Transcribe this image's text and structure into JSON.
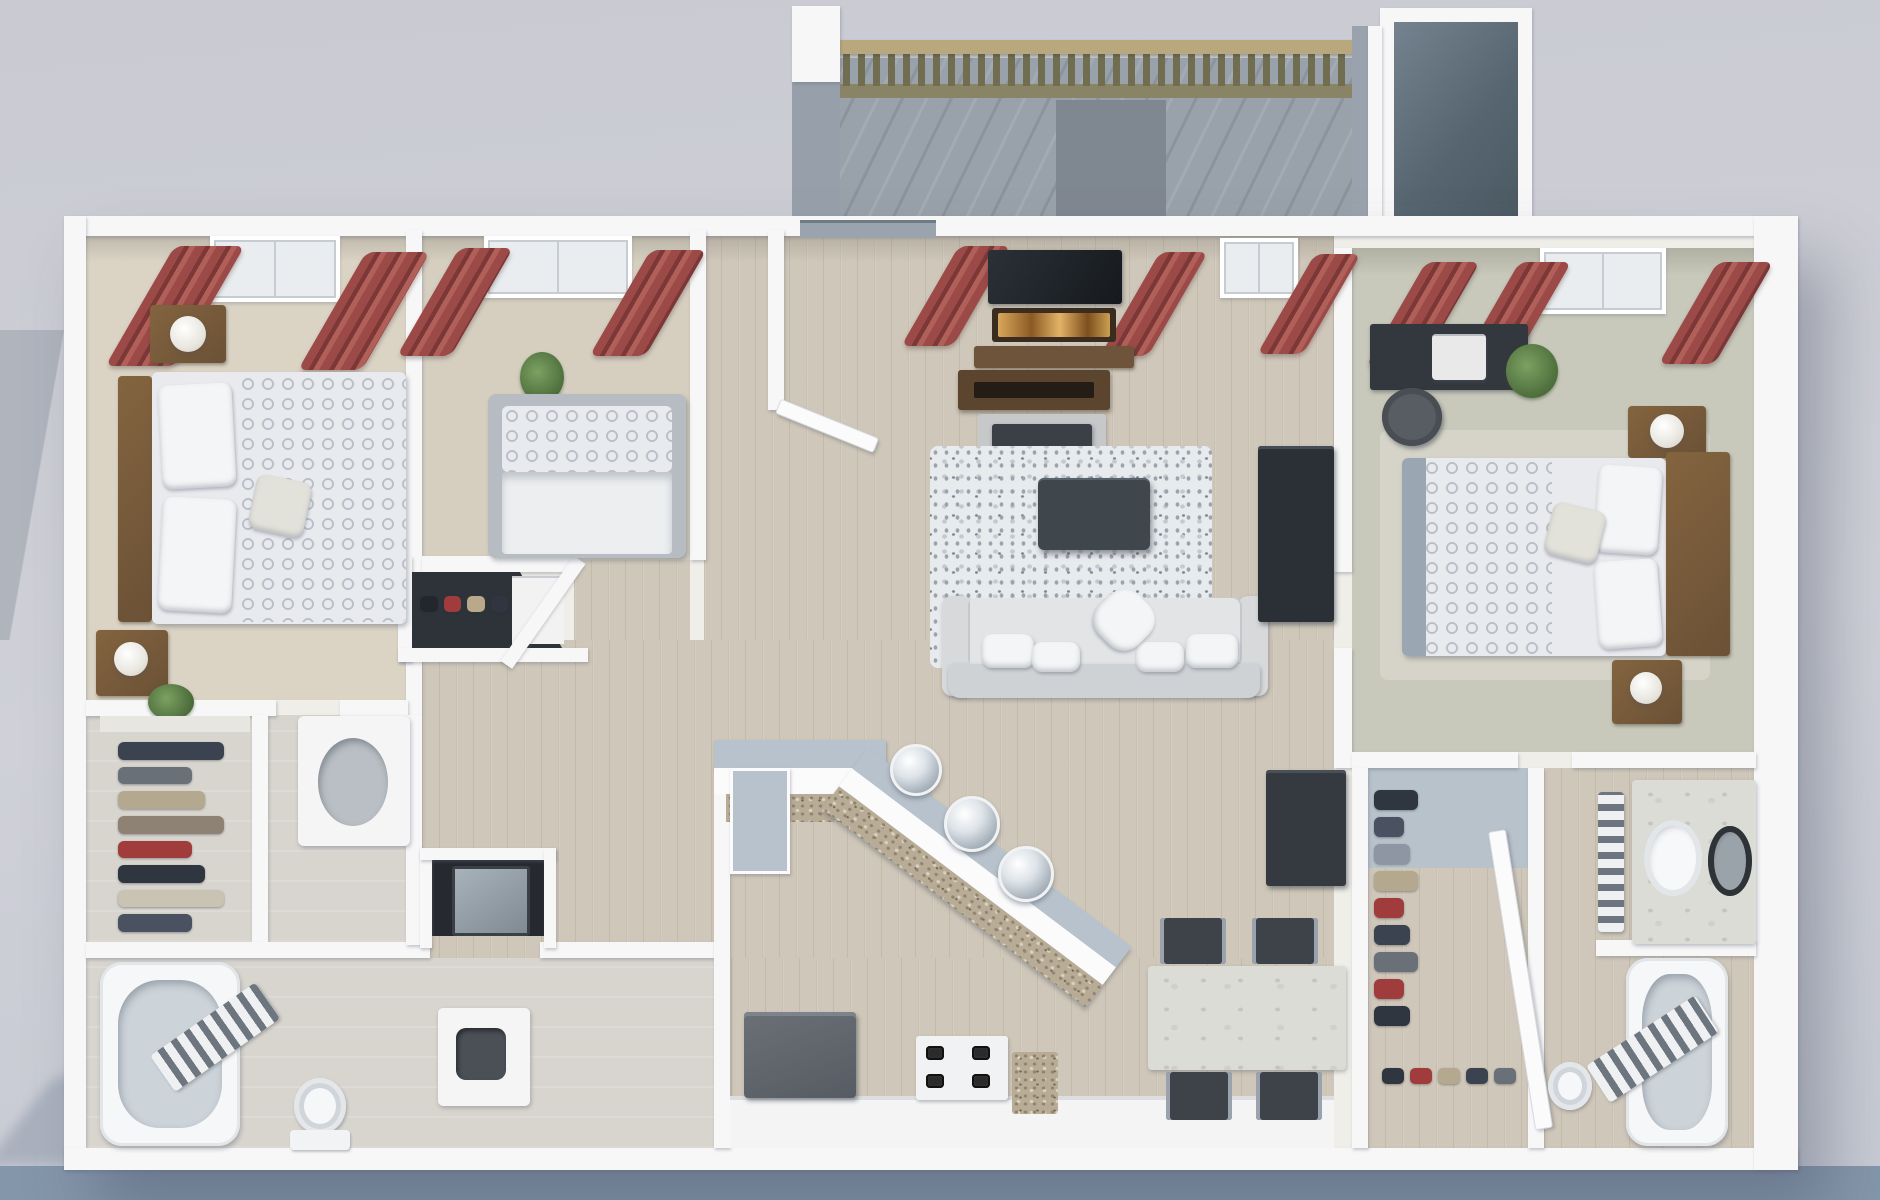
{
  "scene": {
    "type": "3d-floorplan-render",
    "view": "top-down-3d",
    "description": "3D rendered floor plan of a three-bedroom two-bath apartment with open living, kitchen, dining, walk-in closets and balcony"
  },
  "palette": {
    "wall": "#f7f7f8",
    "bgBand": "#8496aa",
    "wood": "#cfc7b9",
    "carpet1": "#dbd4c5",
    "carpet2": "#d6cfc0",
    "carpet3": "#c8c9bb",
    "tile": "#d8d5cf",
    "deck": "#99a1aa",
    "railWood": "#b9a87e",
    "baluster": "#716d50",
    "slate": "#5c6b78",
    "curtain": "#9c4a48",
    "curtainDark": "#7c3836",
    "headboard": "#6b5136",
    "nightstand": "#7a5c3c",
    "duvetBase": "#e9eaee",
    "duvetRing": "#b9c0c9",
    "sofa": "#d7d9db",
    "rugLight": "#e8ebee",
    "rugDark": "#9aa2ac",
    "coffeeTable": "#3f464c",
    "media": "#2b3036",
    "consoleWood": "#5b452f",
    "fire": "#e8a23c",
    "counterTop": "#b7c2cc",
    "granite": "#b9ac96",
    "appliance": "#565c63",
    "burner": "#2b2b2b",
    "marble": "#dcdcd6",
    "chair": "#3d4349",
    "tubInner": "#ccd3d9",
    "plant": "#4e6e3c",
    "closetDark": "#2e333a",
    "washer": "#7f8a93"
  },
  "closets": {
    "left_walkin": {
      "colors": [
        "#3c4350",
        "#6a7078",
        "#b4a98e",
        "#8d8273",
        "#a03c3c",
        "#2f3640",
        "#c9c3b4",
        "#4a5160"
      ]
    },
    "right_walkin": {
      "colors": [
        "#2f3640",
        "#4a5160",
        "#8d96a2",
        "#b4a98e",
        "#a03c3c",
        "#3c4350",
        "#6a7078",
        "#a03c3c",
        "#2f3640"
      ]
    },
    "right_shoes": {
      "colors": [
        "#2f3640",
        "#a03c3c",
        "#b4a98e",
        "#3c4350",
        "#6a7078"
      ]
    },
    "bedroom2_closet": {
      "colors": [
        "#23262b",
        "#a03c3c",
        "#b9a88a",
        "#2f3640"
      ]
    }
  },
  "rooms": [
    {
      "name": "bedroom-1",
      "furniture": [
        "bed",
        "headboard",
        "pillows",
        "patterned-duvet",
        "nightstand-with-lamp",
        "nightstand-with-lamp",
        "red-curtains",
        "window"
      ]
    },
    {
      "name": "bedroom-2",
      "furniture": [
        "bed",
        "patterned-pillow",
        "duvet",
        "potted-plant",
        "red-curtains",
        "window",
        "closet-with-clothes",
        "shoe-shelf"
      ]
    },
    {
      "name": "living-room",
      "furniture": [
        "sofa",
        "throw-pillows",
        "shag-rug",
        "coffee-table",
        "fireplace-tv-unit",
        "media-console",
        "entry-door",
        "red-curtains",
        "window",
        "sliding-door"
      ]
    },
    {
      "name": "bedroom-3",
      "furniture": [
        "bed",
        "headboard",
        "pillows",
        "patterned-duvet",
        "nightstand-with-lamp",
        "nightstand-with-lamp",
        "desk",
        "office-chair",
        "printer",
        "potted-plant",
        "red-curtains",
        "window"
      ]
    },
    {
      "name": "kitchen",
      "furniture": [
        "breakfast-bar",
        "granite-counter",
        "bar-stools",
        "refrigerator",
        "stove",
        "cabinets"
      ]
    },
    {
      "name": "dining-area",
      "furniture": [
        "dining-table",
        "dining-chairs",
        "buffet-cabinet"
      ]
    },
    {
      "name": "hallway",
      "furniture": [
        "utility-closet-washer"
      ]
    },
    {
      "name": "bathroom-1",
      "furniture": [
        "bathtub",
        "toilet",
        "vanity-sink",
        "towel-ladder"
      ]
    },
    {
      "name": "bathroom-2",
      "furniture": [
        "double-vanity",
        "bathtub",
        "toilet",
        "towel-ladder"
      ]
    },
    {
      "name": "walk-in-closet-left",
      "furniture": [
        "hanging-clothes"
      ]
    },
    {
      "name": "walk-in-closet-right",
      "furniture": [
        "hanging-clothes",
        "shoes",
        "door"
      ]
    },
    {
      "name": "balcony",
      "furniture": [
        "wood-railing",
        "deck",
        "storage-closet"
      ]
    }
  ]
}
